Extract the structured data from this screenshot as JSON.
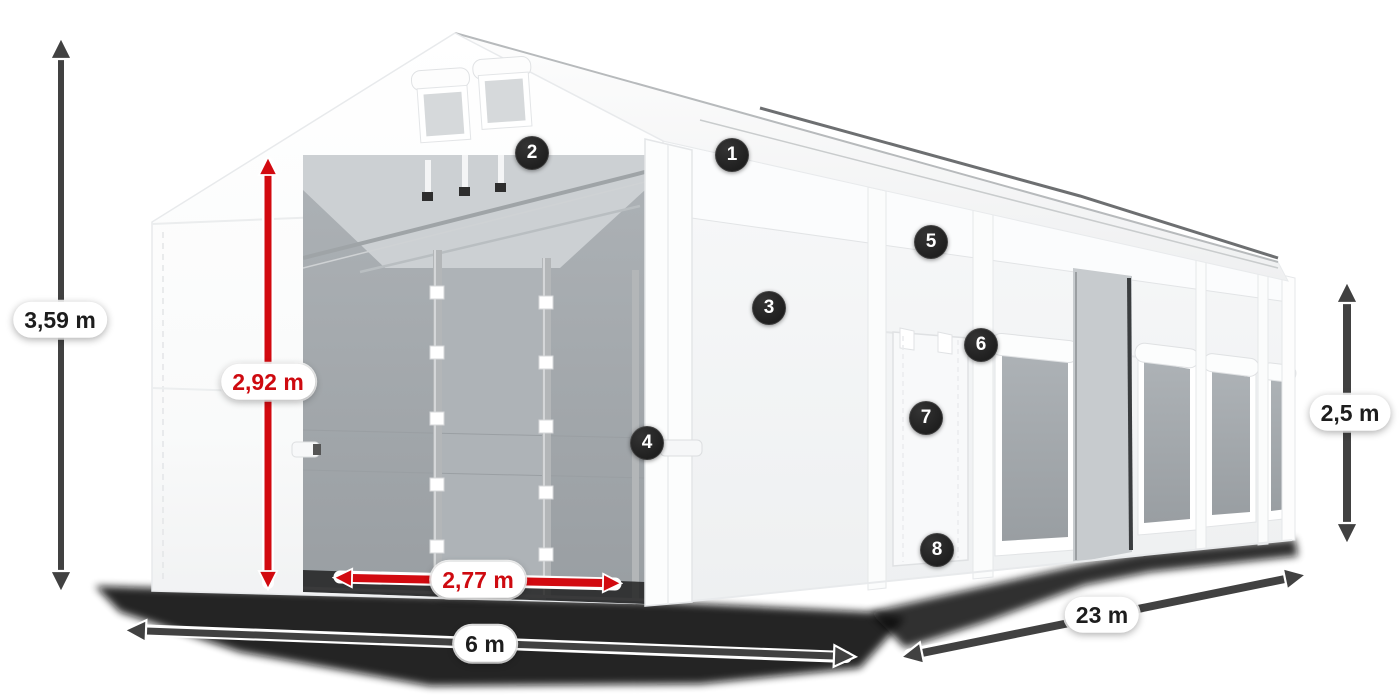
{
  "annotations": {
    "measurements": [
      {
        "id": "total-height",
        "label": "3,59 m",
        "style": "dark"
      },
      {
        "id": "door-height",
        "label": "2,92 m",
        "style": "red"
      },
      {
        "id": "door-width",
        "label": "2,77 m",
        "style": "red"
      },
      {
        "id": "width",
        "label": "6 m",
        "style": "dark"
      },
      {
        "id": "length",
        "label": "23 m",
        "style": "dark"
      },
      {
        "id": "side-height",
        "label": "2,5 m",
        "style": "dark"
      }
    ],
    "callouts": [
      {
        "number": "1"
      },
      {
        "number": "2"
      },
      {
        "number": "3"
      },
      {
        "number": "4"
      },
      {
        "number": "5"
      },
      {
        "number": "6"
      },
      {
        "number": "7"
      },
      {
        "number": "8"
      }
    ]
  },
  "colors": {
    "arrow_dark": "#414141",
    "arrow_red": "#d20a10",
    "label_text_dark": "#1d1d1d",
    "label_text_red": "#ce0a10",
    "label_bg": "#ffffff",
    "badge_bg": "#232323",
    "badge_text": "#ffffff"
  }
}
